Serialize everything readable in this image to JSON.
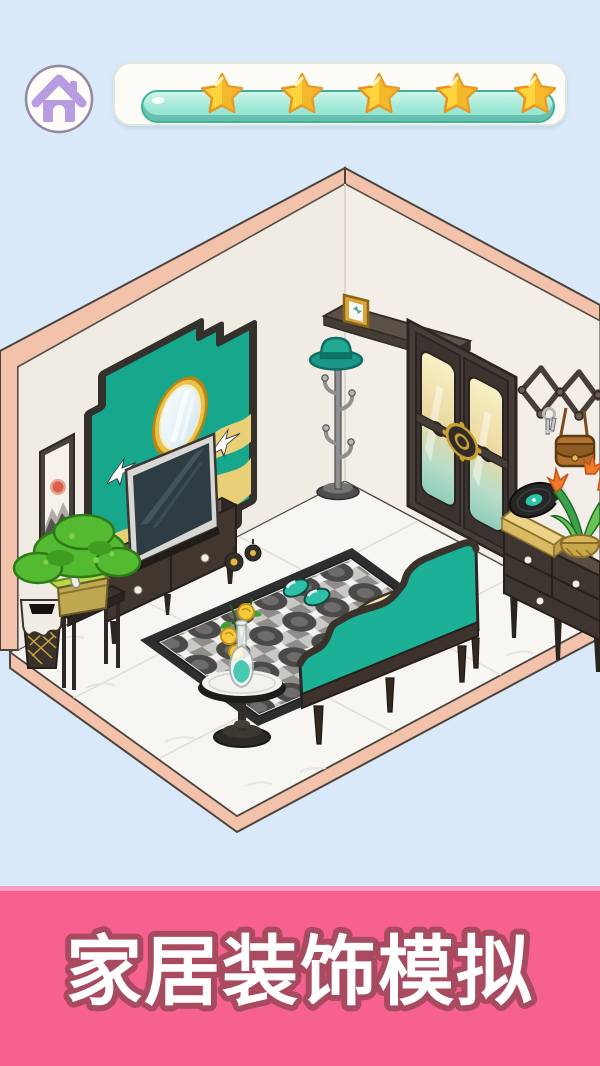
{
  "banner": {
    "title": "家居装饰模拟"
  },
  "header": {
    "home_button": {
      "icon": "home-icon"
    },
    "progress": {
      "icon": "star-icon",
      "stars_total": 5,
      "stars_filled": 5,
      "fill_percent": 100
    }
  },
  "room": {
    "objects": [
      "ink-scroll-painting",
      "teal-accent-panel",
      "oval-gold-mirror",
      "crane-motifs",
      "television",
      "tv-cabinet",
      "bonsai-tree",
      "bonsai-stool",
      "waste-bin",
      "coat-rack",
      "teal-hat",
      "corner-wall-shelf",
      "photo-frame",
      "double-door",
      "gold-door-medallion",
      "accordion-wall-hook",
      "hanging-keys",
      "satchel-bag",
      "drawer-cabinet",
      "record-player",
      "potted-plant",
      "patterned-rug",
      "teal-daybed-sofa",
      "seat-cushion",
      "round-side-table",
      "flower-vase",
      "yellow-flowers",
      "teal-slippers"
    ]
  },
  "colors": {
    "background": "#d9e9fa",
    "accent_teal": "#1aa78e",
    "sofa_teal": "#1cb096",
    "edge_pink": "#f2c2ab",
    "wall_cream": "#f0ebe3",
    "floor_white": "#f8f6f2",
    "wood_dark": "#3e3531",
    "gold": "#d9a63a",
    "star_gold": "#ffd43c",
    "bar_teal": "#9fe8d6",
    "banner_pink": "#f7618f",
    "banner_text_outline": "#a84a60",
    "home_icon_purple": "#b79ce2"
  }
}
